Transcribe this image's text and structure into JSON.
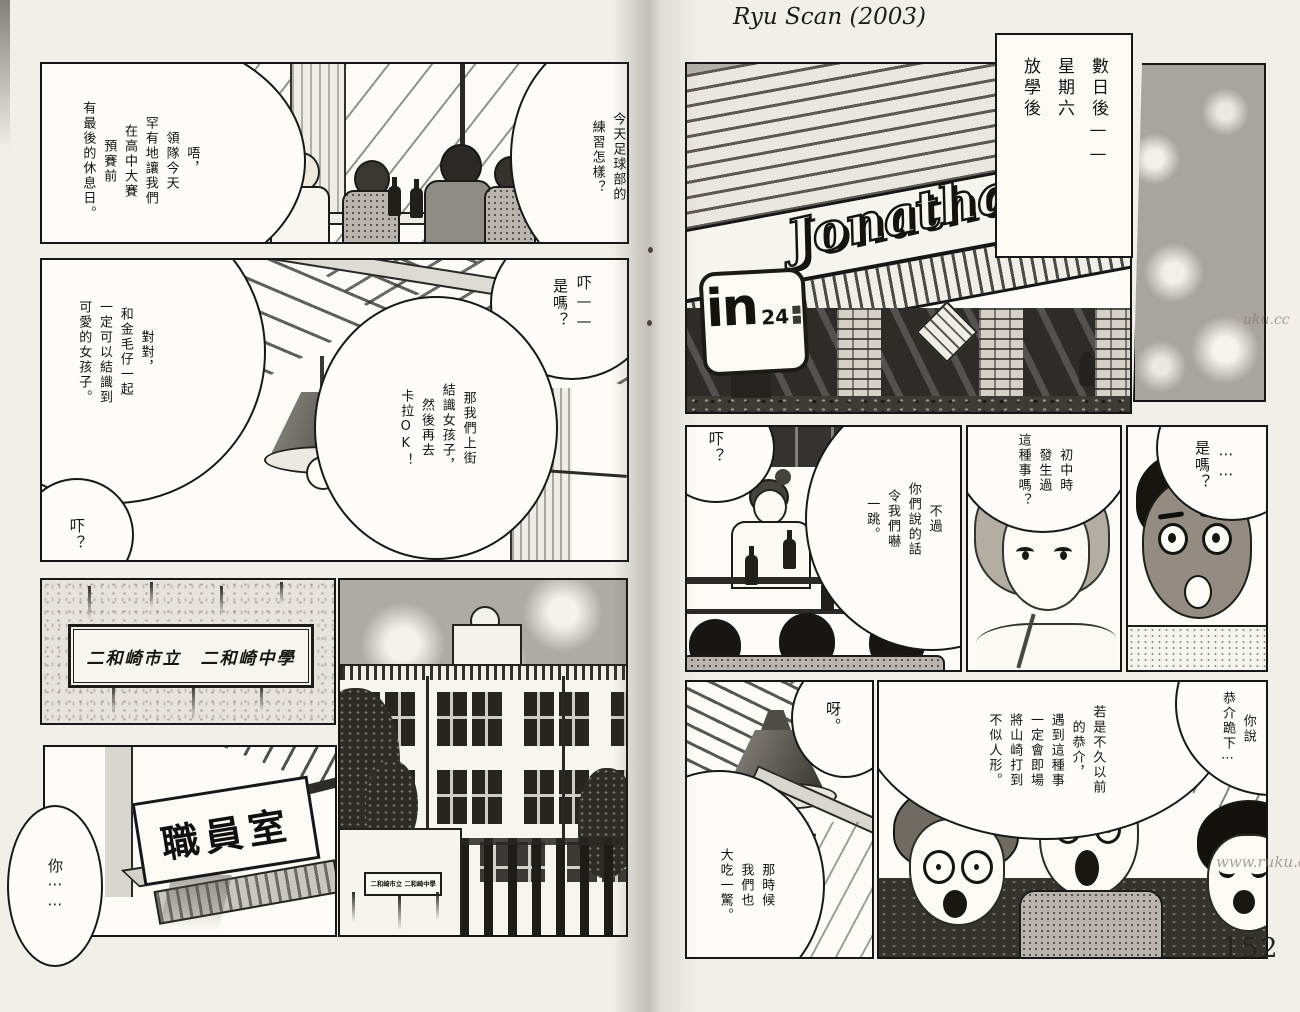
{
  "scan": {
    "credit": "Ryu Scan (2003)",
    "page_number": "152",
    "watermark_edge": "uku.cc",
    "watermark_corner": "www.ruku.cc"
  },
  "left_page": {
    "diner_panel": {
      "bubble_question": "那麼，\n今天足球部的\n練習怎樣？",
      "bubble_answer": "唔，\n領隊今天\n罕有地讓我們\n在高中大賽\n預賽前\n有最後的休息日。"
    },
    "lamp_panel": {
      "bubble_eh": "吓——\n是嗎？",
      "bubble_plan": "那我們上街\n結識女孩子，\n然後再去\n卡拉OK！",
      "bubble_agree": "對對，\n和金毛仔一起\n一定可以結識到\n可愛的女孩子。",
      "bubble_huh": "吓？"
    },
    "plaque_panel": {
      "school_plaque": "二和崎市立　二和崎中學"
    },
    "staffroom_panel": {
      "room_sign": "職員室",
      "bubble_you": "你⋯⋯"
    },
    "building_panel": {
      "wall_plaque": "二和崎市立 二和崎中學"
    }
  },
  "right_page": {
    "caption": "數日後——\n星期六\n放學後",
    "exterior_panel": {
      "logo": "Jonathan",
      "sign_in": "in",
      "sign_24": "24"
    },
    "counter_panel": {
      "bubble_huh": "吓？",
      "bubble_surprised": "不過\n你們說的話\n令我們嚇\n一跳。"
    },
    "girl_panel": {
      "bubble_ask": "初中時\n發生過\n這種事嗎？"
    },
    "boy_panel": {
      "bubble_really": "⋯⋯\n是嗎？"
    },
    "lamp_panel": {
      "bubble_ah": "呀。",
      "bubble_shock": "那時候\n我們也\n大吃一驚。"
    },
    "boys_panel": {
      "bubble_kyosuke": "若是不久以前\n的恭介，\n遇到這種事\n一定會即場\n將山崎打到\n不似人形。",
      "bubble_kneel": "你說\n恭介跪下⋯"
    }
  }
}
